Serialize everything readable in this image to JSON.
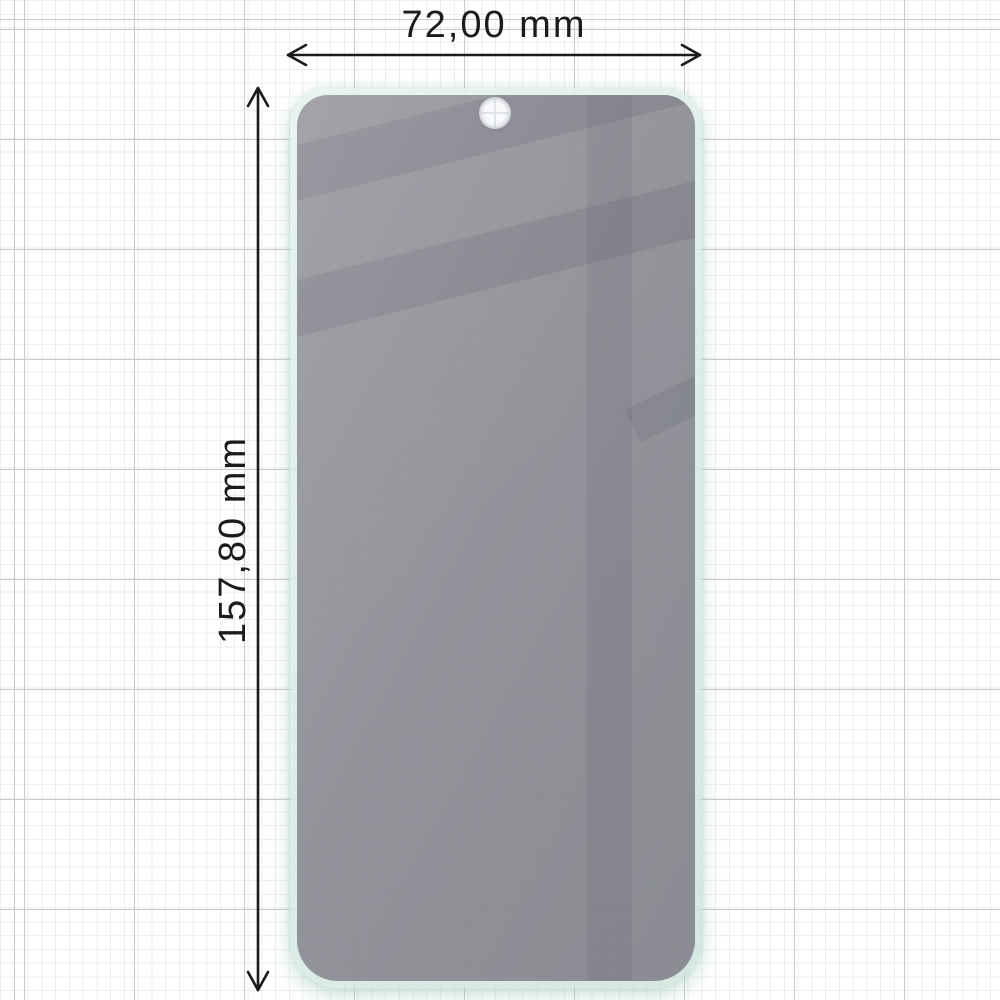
{
  "labels": {
    "width": "72,00 mm",
    "height": "157,80 mm"
  },
  "protector": {
    "width_mm": "72,00",
    "height_mm": "157,80"
  },
  "colors": {
    "paper": "#ffffff",
    "grid_minor": "#ededef",
    "grid_major": "#c9c9cc",
    "arrow": "#1b1b1d",
    "glass_edge": "#d9ebe5",
    "tint_gray": "#98969e",
    "glare_gray": "#8f8d95",
    "hole": "#f8f9fb"
  }
}
